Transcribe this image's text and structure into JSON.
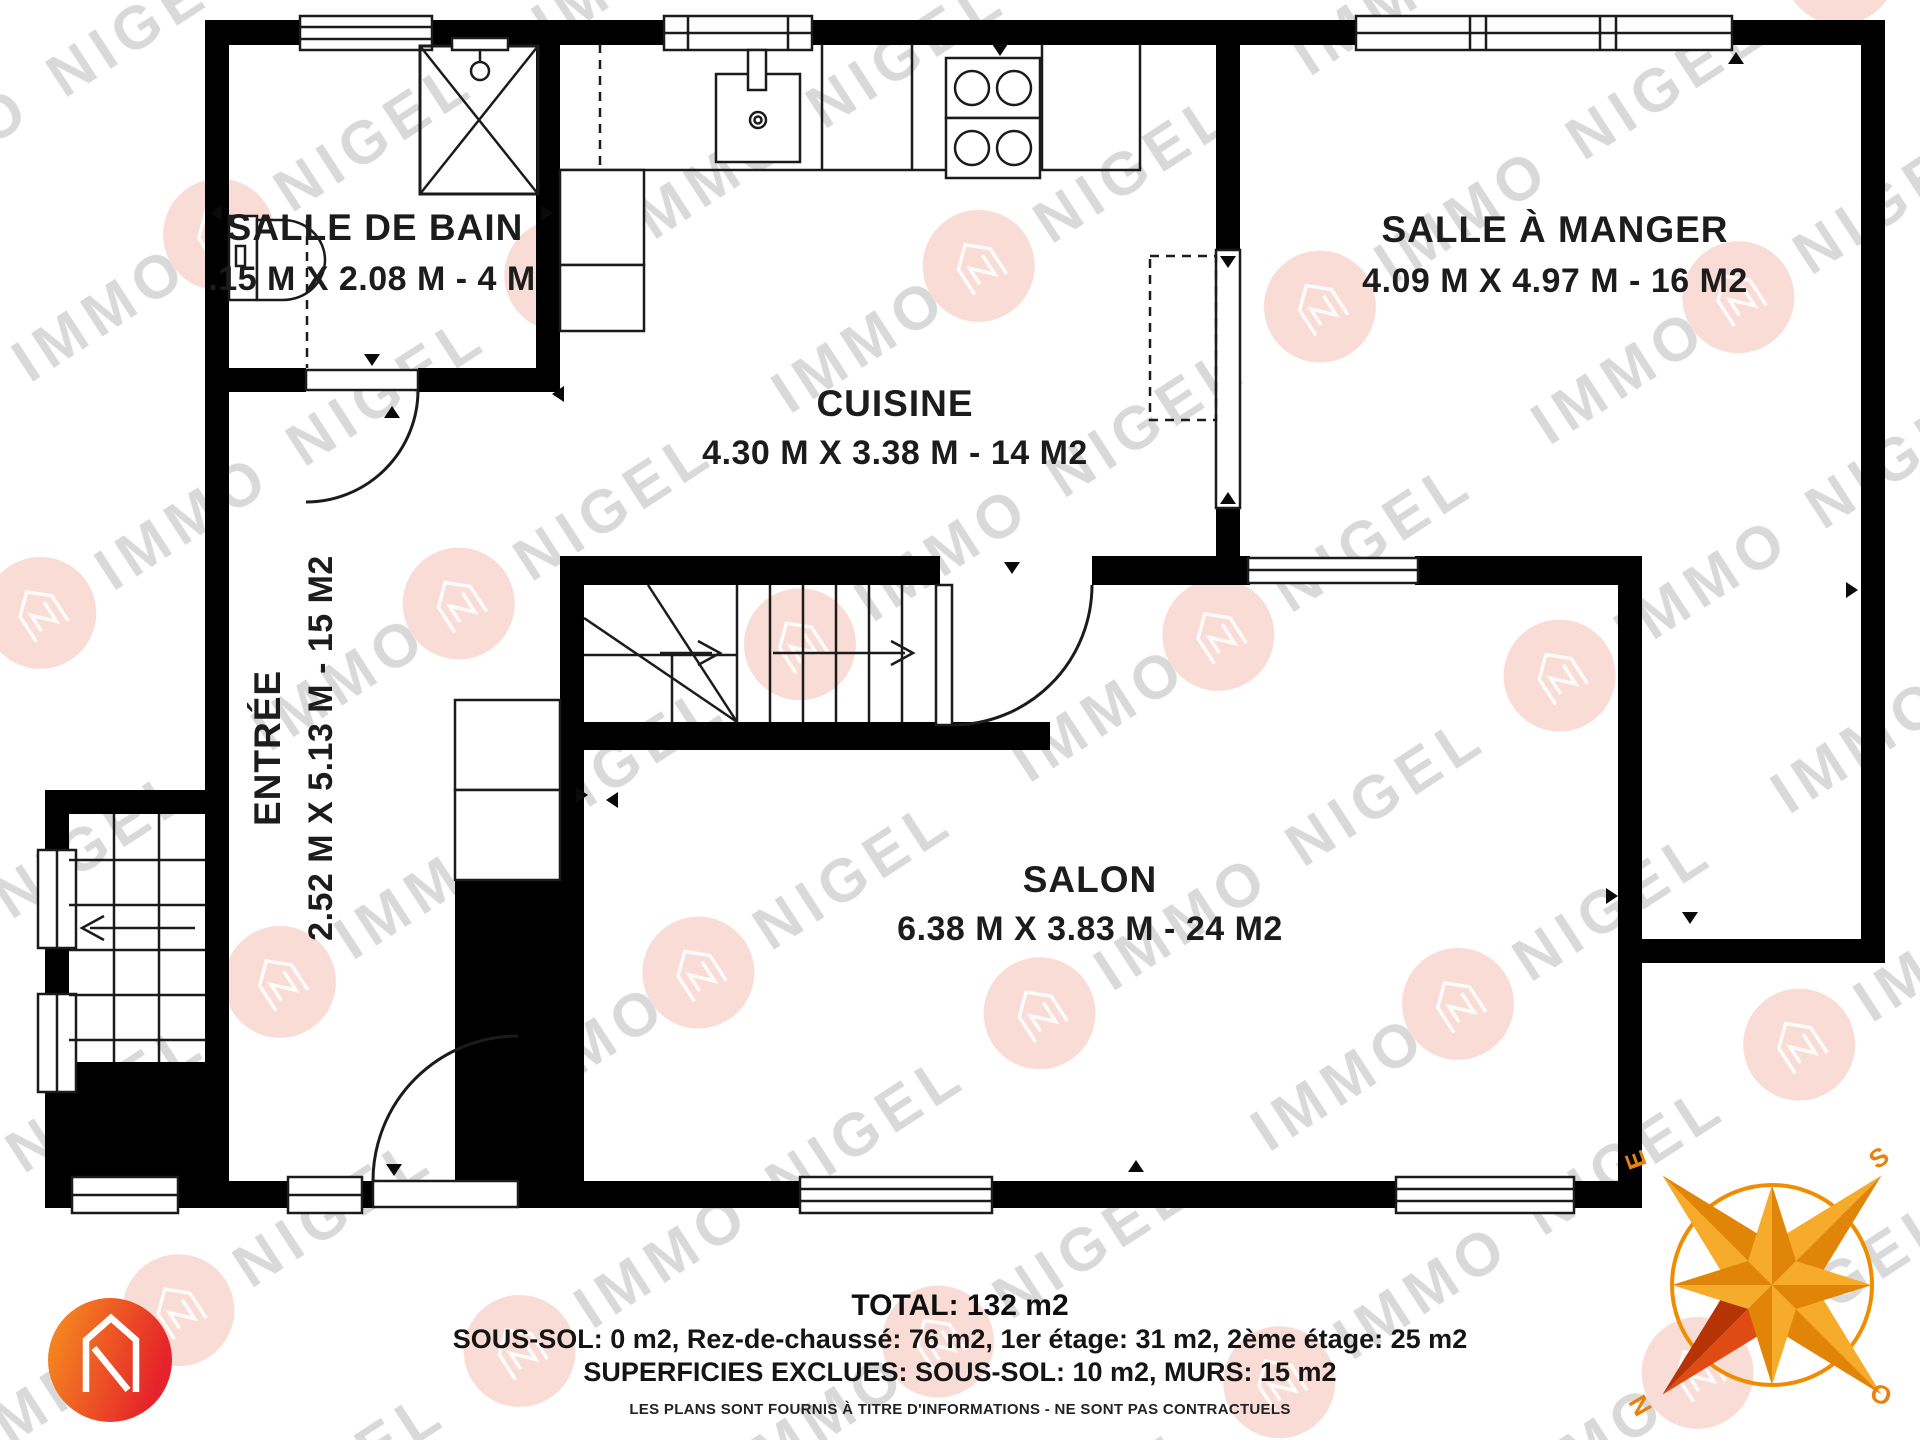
{
  "watermark": {
    "word1": "NIGEL",
    "word2": "IMMO"
  },
  "plan": {
    "rooms": [
      {
        "name": "SALLE DE BAIN",
        "dims": ".15 M X 2.08 M - 4 M"
      },
      {
        "name": "CUISINE",
        "dims": "4.30 M X 3.38 M - 14 M2"
      },
      {
        "name": "SALLE À MANGER",
        "dims": "4.09 M X 4.97 M - 16 M2"
      },
      {
        "name": "ENTRÉE",
        "dims": "2.52 M X 5.13 M - 15 M2"
      },
      {
        "name": "SALON",
        "dims": "6.38 M X 3.83 M - 24 M2"
      }
    ]
  },
  "summary": {
    "total": "TOTAL: 132 m2",
    "floors": "SOUS-SOL: 0 m2, Rez-de-chaussé: 76 m2, 1er étage: 31 m2, 2ème étage: 25 m2",
    "excluded": "SUPERFICIES EXCLUES: SOUS-SOL: 10 m2, MURS: 15 m2",
    "disclaimer": "LES PLANS SONT FOURNIS À TITRE D'INFORMATIONS - NE SONT PAS CONTRACTUELS"
  },
  "compass": {
    "north": "N",
    "south": "S",
    "east": "E",
    "west": "O"
  },
  "colors": {
    "wall": "#000000",
    "line": "#1b1b1b",
    "watermark_text": "#d9d9d9",
    "watermark_badge": "#f4beb2",
    "logo_orange": "#f7941e",
    "logo_red": "#e5232a",
    "compass_light": "#f6ab2a",
    "compass_dark": "#e08507",
    "compass_red_light": "#e04a13",
    "compass_red_dark": "#b63305"
  }
}
